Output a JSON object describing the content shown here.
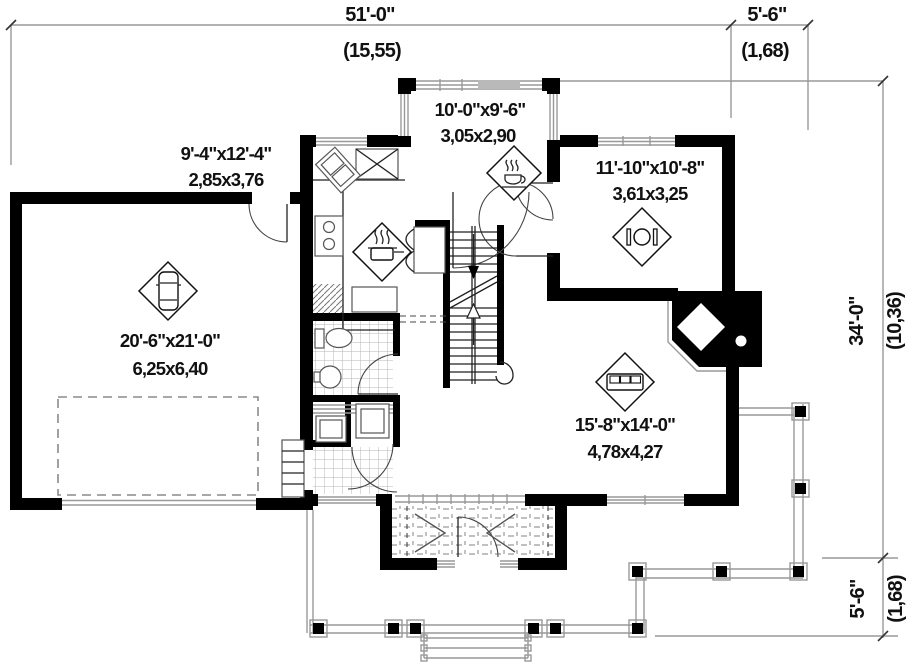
{
  "page": {
    "background": "#ffffff"
  },
  "plan": {
    "dimensions": {
      "top": {
        "ft": "51'-0\"",
        "m": "(15,55)"
      },
      "top_right": {
        "ft": "5'-6\"",
        "m": "(1,68)"
      },
      "right": {
        "ft": "34'-0\"",
        "m": "(10,36)"
      },
      "bottom_right": {
        "ft": "5'-6\"",
        "m": "(1,68)"
      }
    },
    "rooms": {
      "dinette": {
        "ft": "10'-0\"x9'-6\"",
        "m": "3,05x2,90"
      },
      "kitchen": {
        "ft": "9'-4\"x12'-4\"",
        "m": "2,85x3,76"
      },
      "dining": {
        "ft": "11'-10\"x10'-8\"",
        "m": "3,61x3,25"
      },
      "garage": {
        "ft": "20'-6\"x21'-0\"",
        "m": "6,25x6,40"
      },
      "living": {
        "ft": "15'-8\"x14'-0\"",
        "m": "4,78x4,27"
      }
    },
    "icons": {
      "garage": "car-icon",
      "dinette": "coffee-cup-icon",
      "kitchen": "cooking-pot-icon",
      "dining": "dining-table-icon",
      "living": "sofa-icon"
    },
    "colors": {
      "wall": "#000000",
      "thin_line": "#555555",
      "light_line": "#999999",
      "text": "#111111"
    }
  }
}
